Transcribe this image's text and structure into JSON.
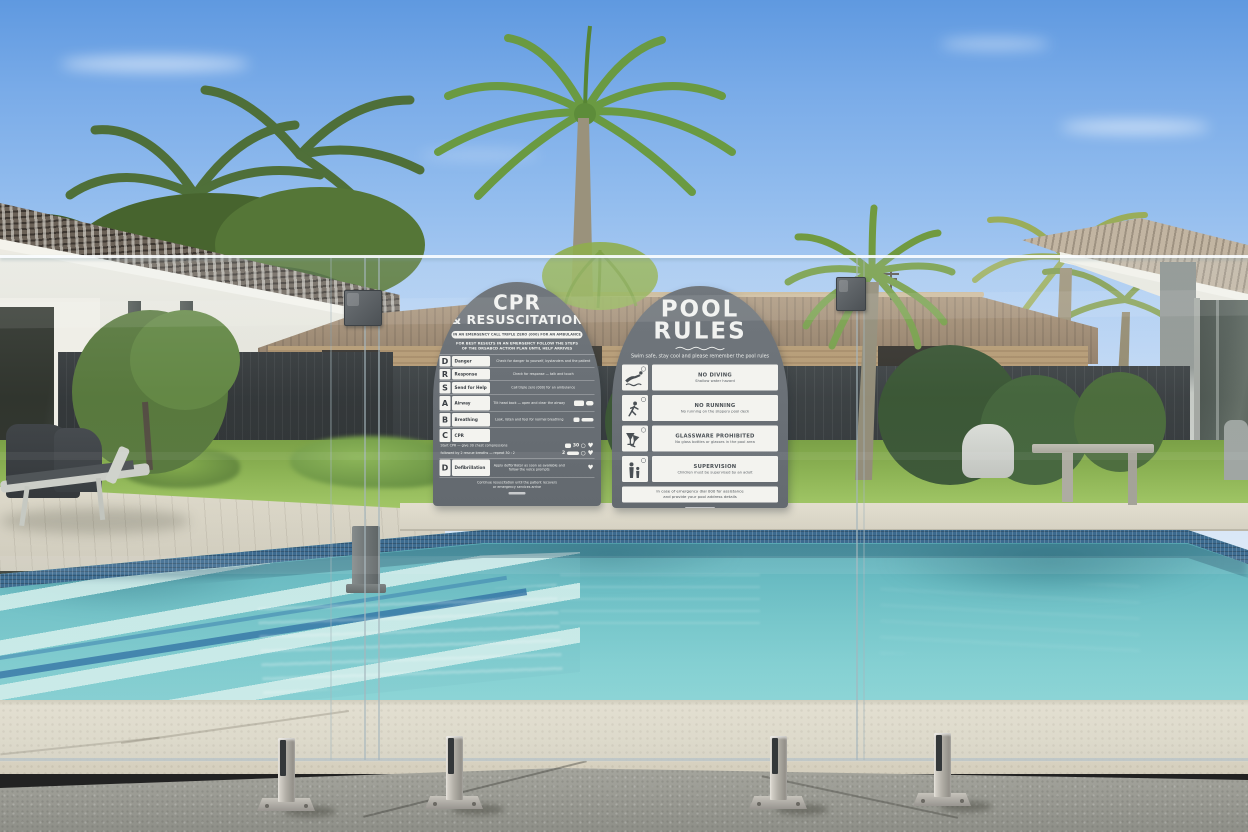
{
  "cpr_sign": {
    "title_line1": "CPR",
    "title_line2": "& RESUSCITATION",
    "banner": "IN AN EMERGENCY CALL TRIPLE ZERO (000) FOR AN AMBULANCE",
    "intro_line1": "FOR BEST RESULTS IN AN EMERGENCY FOLLOW THE STEPS",
    "intro_line2": "OF THE DRSABCD ACTION PLAN UNTIL HELP ARRIVES",
    "rows": [
      {
        "letter": "D",
        "label": "Danger",
        "text": "Check for danger to yourself, bystanders and the patient"
      },
      {
        "letter": "R",
        "label": "Response",
        "text": "Check for response — talk and touch"
      },
      {
        "letter": "S",
        "label": "Send for Help",
        "text": "Call triple zero (000) for an ambulance"
      },
      {
        "letter": "A",
        "label": "Airway",
        "text": "Tilt head back — open and clear the airway"
      },
      {
        "letter": "B",
        "label": "Breathing",
        "text": "Look, listen and feel for normal breathing"
      },
      {
        "letter": "C",
        "label": "CPR",
        "text": "Start CPR — give 30 chest compressions",
        "text2": "followed by 2 rescue breaths — repeat 30 : 2"
      },
      {
        "letter": "D",
        "label": "Defibrillation",
        "text": "Apply defibrillator as soon as available and follow the voice prompts"
      }
    ],
    "footer_line1": "Continue resuscitation until the patient recovers",
    "footer_line2": "or emergency services arrive"
  },
  "pool_rules_sign": {
    "title_line1": "POOL",
    "title_line2": "RULES",
    "subtitle": "Swim safe, stay cool and please remember the pool rules",
    "rules": [
      {
        "icon": "no-diving-icon",
        "heading": "NO DIVING",
        "sub": "Shallow water hazard"
      },
      {
        "icon": "no-running-icon",
        "heading": "NO RUNNING",
        "sub": "No running on the slippery pool deck"
      },
      {
        "icon": "no-glassware-icon",
        "heading": "GLASSWARE PROHIBITED",
        "sub": "No glass bottles or glasses in the pool area"
      },
      {
        "icon": "supervision-icon",
        "heading": "SUPERVISION",
        "sub": "Children must be supervised by an adult"
      }
    ],
    "footer_line1": "In case of emergency dial 000 for assistance",
    "footer_line2": "and provide your pool address details"
  },
  "colors": {
    "sky_top": "#5f99e0",
    "sky_horizon": "#dde9f8",
    "pool_water": "#6ac2c6",
    "waterline_tile": "#2b5d85",
    "sign_grey": "#6b7177",
    "lawn_green": "#85ae46",
    "fence_dark": "#2b2f31",
    "deck_paver": "#ded8c6",
    "concrete_grey": "#9b9c94",
    "stainless_steel": "#b3b0a8"
  }
}
